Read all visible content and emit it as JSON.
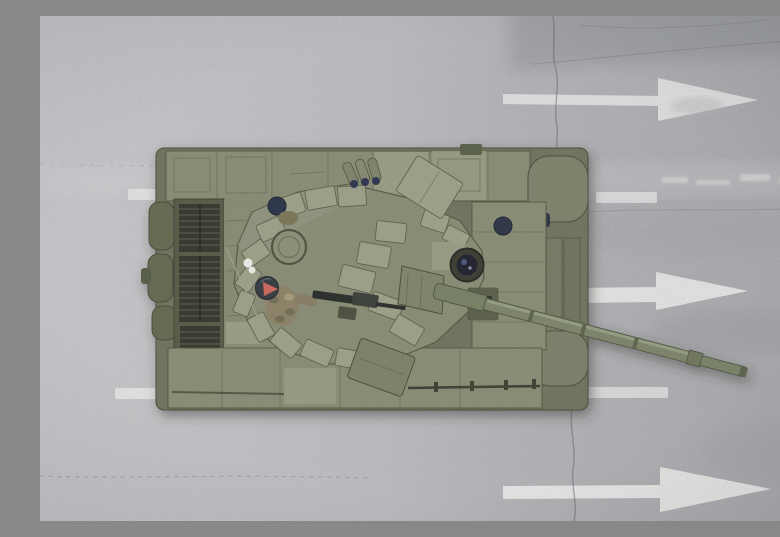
{
  "meta": {
    "title": "Aerial top-down view of a main battle tank on an asphalt road",
    "description": "Top-down aerial photograph of an olive-green main battle tank with explosive reactive armour blocks, open hatch with a crew member, roof machine gun and a long thermal-sleeved gun barrel pointing right, driving on a grey asphalt road marked with three white right-pointing direction arrows, dashed lane lines and thin cracks."
  },
  "colors": {
    "road-base": "#b1b2b5",
    "marking-white": "#eff0ec",
    "road-crack": "#5f6166",
    "tank-hull": "#878b73",
    "tank-hull-light": "#989b83",
    "tank-hull-dark": "#6e725d",
    "tank-edge": "#51553f",
    "grille-dark": "#34382d",
    "grille-slat": "#666a55",
    "era-block": "#9b9e86",
    "era-edge": "#5c604b",
    "fender-dark": "#63674f",
    "barrel": "#7b8269",
    "barrel-light": "#9aa184",
    "sight-dark": "#20242f",
    "helmet-dark": "#343a41",
    "helmet-navy": "#2c3448",
    "patch-red": "#c9685c",
    "uniform-camo": "#8b8166",
    "uniform-camo-dark": "#6a6b50",
    "mg-dark": "#2b2f2c",
    "cloth-white": "#e8e9e2"
  },
  "scene": {
    "road": {
      "label": "grey asphalt road seen from directly above"
    },
    "markings": {
      "arrows": [
        {
          "id": "arrow-top",
          "direction": "right",
          "condition": "worn"
        },
        {
          "id": "arrow-middle",
          "direction": "right",
          "condition": "worn"
        },
        {
          "id": "arrow-bottom",
          "direction": "right",
          "condition": "fresh"
        }
      ],
      "lane_dashes": [
        {
          "id": "dash-upper-left"
        },
        {
          "id": "dash-upper-right"
        },
        {
          "id": "dash-lower-left"
        },
        {
          "id": "dash-lower-right"
        }
      ]
    },
    "tank": {
      "label": "main battle tank, top view",
      "heading": "gun barrel pointing to the right",
      "features": [
        "reactive armour blocks on turret",
        "engine deck grilles at rear",
        "open hatch with crew member wearing helmet with red patch",
        "roof-mounted machine gun",
        "smoke grenade launchers",
        "thermal-sleeved gun barrel"
      ]
    }
  }
}
